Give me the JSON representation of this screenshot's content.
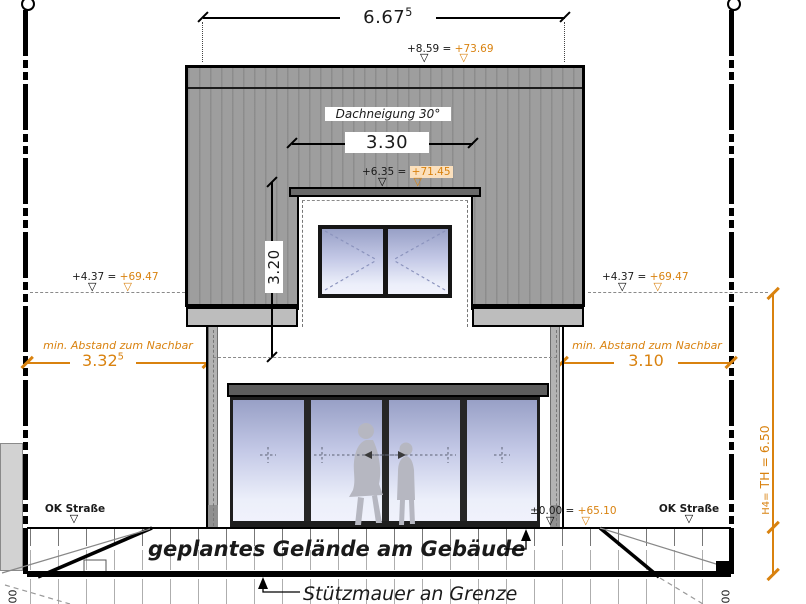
{
  "symbols": {
    "level_triangle": "▽"
  },
  "colors": {
    "accent_orange": "#d9820f",
    "highlight_peach": "#fbe0bd",
    "roof_gray": "#9e9e9e",
    "glass_top": "#98a0c6",
    "glass_bottom": "#f1f2fc"
  },
  "dimensions": {
    "overall_width": {
      "main": "6.67",
      "sup": "5"
    },
    "dormer_width": "3.30",
    "roof_height": "3.20",
    "setback_left": {
      "label": "min. Abstand zum Nachbar",
      "main": "3.32",
      "sup": "5"
    },
    "setback_right": {
      "label": "min. Abstand zum Nachbar",
      "value": "3.10"
    },
    "wall_height": {
      "prefix": "H4=",
      "value": "TH = 6.50"
    },
    "cut_left": "00",
    "cut_right": "00"
  },
  "levels": {
    "ridge": {
      "rel": "+8.59 =",
      "abs": "+73.69"
    },
    "dormer_roof": {
      "rel": "+6.35 =",
      "abs": "+71.45"
    },
    "eaves_left": {
      "rel": "+4.37 =",
      "abs": "+69.47"
    },
    "eaves_right": {
      "rel": "+4.37 =",
      "abs": "+69.47"
    },
    "ground_floor": {
      "rel": "±0.00 =",
      "abs": "+65.10"
    }
  },
  "labels": {
    "roof_pitch": "Dachneigung 30°",
    "street_left": "OK Straße",
    "street_right": "OK Straße",
    "planned_grade": "geplantes Gelände am Gebäude",
    "retaining_wall": "Stützmauer an Grenze"
  }
}
